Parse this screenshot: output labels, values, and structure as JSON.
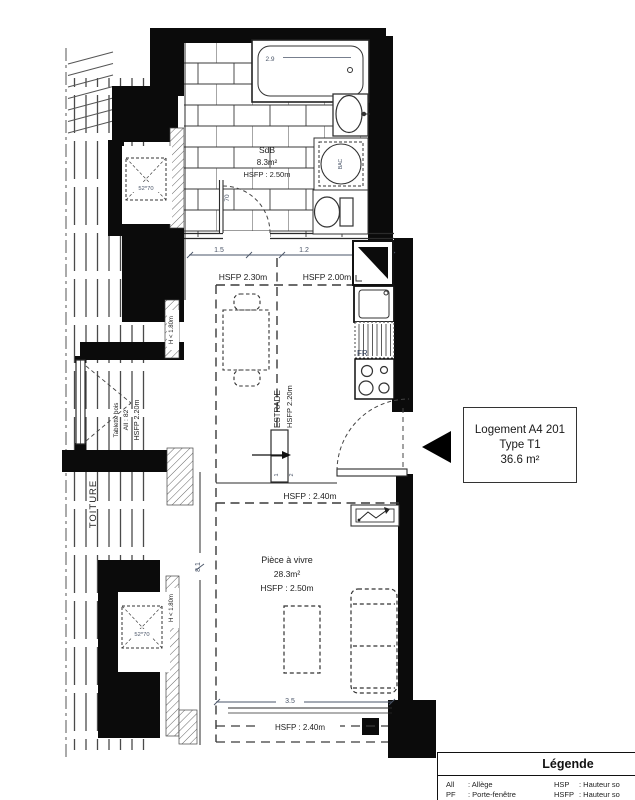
{
  "rooms": {
    "bathroom": {
      "name": "SdB",
      "area": "8.3m²",
      "ceiling": "HSFP : 2.50m",
      "tub_dim": "2.9",
      "door_width": "70",
      "tray_label": "BAC"
    },
    "kitchen": {
      "dim_left": "1.5",
      "dim_right": "1.2",
      "ceiling_left": "HSFP 2.30m",
      "ceiling_right": "HSFP 2.00m",
      "fridge": "FR",
      "estrade": "ESTRADE",
      "estrade_ceiling": "HSFP 2.20m",
      "step_one": "1",
      "step_two": "2"
    },
    "living": {
      "name": "Pièce à vivre",
      "area": "28.3m²",
      "ceiling": "HSFP : 2.50m",
      "ceiling_upper": "HSFP : 2.40m",
      "ceiling_lower": "HSFP : 2.40m",
      "width_dim": "3.5",
      "height_dim": "8.1"
    },
    "alcove": {
      "shelf": "Tablette bois",
      "sill": "All : 82",
      "ceiling": "HSFP 2.20m"
    },
    "skylight_top": "52*70",
    "skylight_bottom": "52*70",
    "low_height_mid": "H < 1.80m",
    "low_height_bottom": "H < 1.80m",
    "roof": "TOITURE"
  },
  "unit": {
    "line1": "Logement A4 201",
    "line2": "Type T1",
    "line3": "36.6 m²"
  },
  "legend": {
    "title": "Légende",
    "rows": [
      {
        "abbr_left": "All",
        "desc_left": ": Allège",
        "abbr_right": "HSP",
        "desc_right": ": Hauteur so"
      },
      {
        "abbr_left": "PF",
        "desc_left": ": Porte-fenêtre",
        "abbr_right": "HSFP",
        "desc_right": ": Hauteur so"
      }
    ]
  },
  "colors": {
    "wall": "#0b0b0b",
    "line": "#2b2b2b",
    "dim_text": "#4a5568"
  }
}
